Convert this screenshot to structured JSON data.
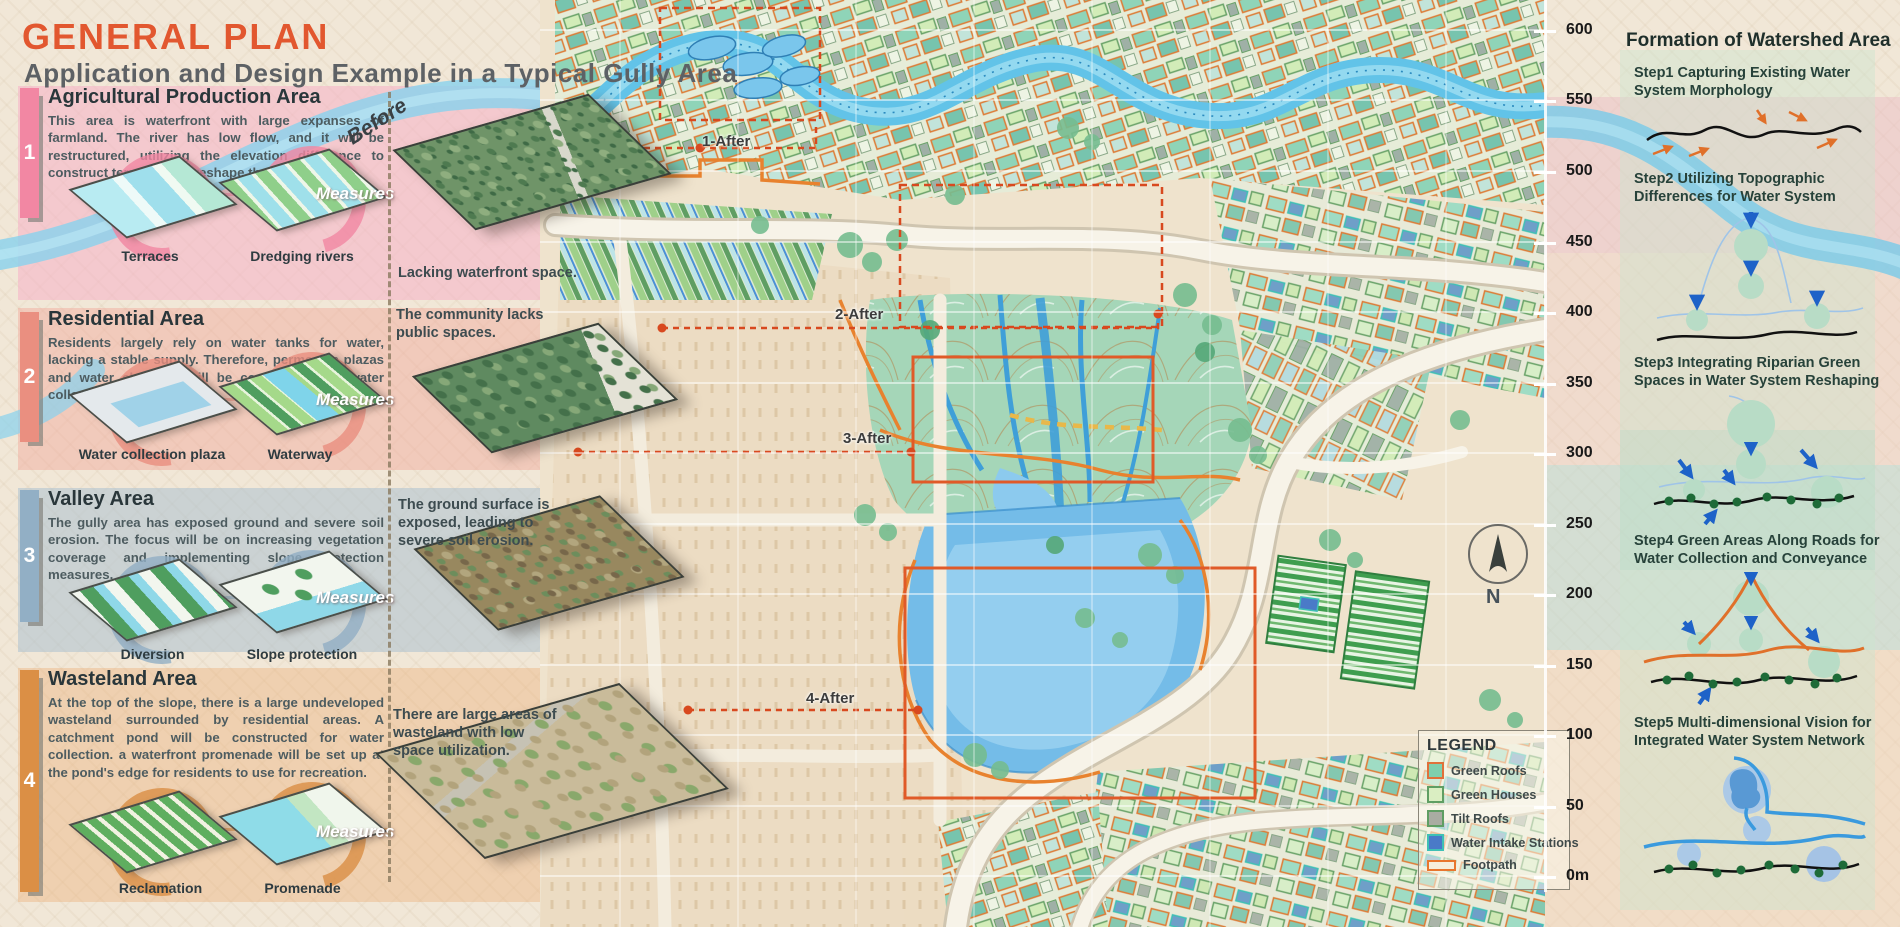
{
  "header": {
    "title": "GENERAL PLAN",
    "subtitle": "Application and Design Example in a Typical Gully Area"
  },
  "before_label": "Before",
  "sections": [
    {
      "num": "1",
      "title": "Agricultural Production Area",
      "description": "This area is waterfront with large expanses of farmland. The river has low flow, and it will be restructured, utilizing the elevation difference to construct terraces and reshape the site.",
      "measures_label": "Measures",
      "measure1": "Terraces",
      "measure2": "Dredging rivers",
      "caption": "Lacking waterfront space.",
      "accent": "#f287a3"
    },
    {
      "num": "2",
      "title": "Residential Area",
      "description": "Residents largely rely on water tanks for water, lacking a stable supply. Therefore, permeable plazas and water channels will be constructed for water collection.",
      "measures_label": "Measures",
      "measure1": "Water collection plaza",
      "measure2": "Waterway",
      "caption": "The community lacks public spaces.",
      "accent": "#ea8f80"
    },
    {
      "num": "3",
      "title": "Valley Area",
      "description": "The gully area has exposed ground and severe soil erosion. The focus will be on increasing vegetation coverage and implementing slope protection measures.",
      "measures_label": "Measures",
      "measure1": "Diversion",
      "measure2": "Slope protection",
      "caption": "The ground surface is exposed, leading to severe soil erosion.",
      "accent": "#92afc5"
    },
    {
      "num": "4",
      "title": "Wasteland Area",
      "description": "At the top of the slope, there is a large undeveloped wasteland surrounded by residential areas. A catchment pond will be constructed for water collection. a waterfront promenade will be set up at the pond's edge for residents to use for recreation.",
      "measures_label": "Measures",
      "measure1": "Reclamation",
      "measure2": "Promenade",
      "caption": "There are large areas of wasteland with low space utilization.",
      "accent": "#db8f45"
    }
  ],
  "map": {
    "after_labels": {
      "a1": "1-After",
      "a2": "2-After",
      "a3": "3-After",
      "a4": "4-After"
    },
    "compass_label": "N",
    "legend": {
      "title": "LEGEND",
      "items": [
        {
          "label": "Green Roofs",
          "fill": "#7fd0ae",
          "border": "#e0713a"
        },
        {
          "label": "Green Houses",
          "fill": "#daeec2",
          "border": "#5f9e63"
        },
        {
          "label": "Tilt Roofs",
          "fill": "#a9aca2",
          "border": "#5f9e63"
        },
        {
          "label": "Water Intake Stations",
          "fill": "#4a7ac8",
          "border": "#3fc0b5"
        },
        {
          "label": "Footpath",
          "fill": "#f6eedc",
          "border": "#e8762e"
        }
      ]
    }
  },
  "elevation": {
    "ticks": [
      "600",
      "550",
      "500",
      "450",
      "400",
      "350",
      "300",
      "250",
      "200",
      "150",
      "100",
      "50",
      "0m"
    ]
  },
  "watershed": {
    "title": "Formation of Watershed Area",
    "steps": [
      {
        "text": "Step1 Capturing Existing Water System Morphology"
      },
      {
        "text": "Step2 Utilizing Topographic Differences for Water System"
      },
      {
        "text": "Step3 Integrating Riparian Green Spaces in Water System Reshaping"
      },
      {
        "text": "Step4 Green Areas Along Roads for Water Collection and Conveyance"
      },
      {
        "text": "Step5 Multi-dimensional Vision for Integrated Water System Network"
      }
    ]
  }
}
